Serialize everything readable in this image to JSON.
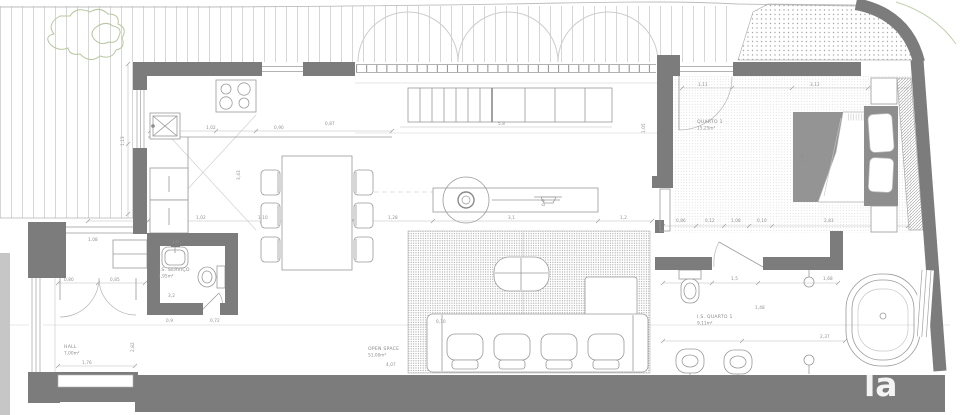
{
  "document": {
    "type": "floor-plan",
    "style": "architectural drawing, top view"
  },
  "watermark": "la",
  "colors": {
    "wall": "#7c7c7c",
    "bed_fill": "#949494",
    "headboard_fill": "#8e8e8e",
    "furniture_line": "#9a9a9a",
    "deck_line": "#d6d6d6",
    "dim_text": "#8e8e8e",
    "plant_green": "#b8c7a0",
    "background": "#ffffff"
  },
  "rooms": [
    {
      "id": "quarto1",
      "name": "QUARTO 1",
      "area": "15,25m²"
    },
    {
      "id": "is_quarto1",
      "name": "I.S. QUARTO 1",
      "area": "9,11m²"
    },
    {
      "id": "open_space",
      "name": "OPEN SPACE",
      "area": "51,00m²"
    },
    {
      "id": "hall",
      "name": "HALL",
      "area": "7,00m²"
    },
    {
      "id": "is_servico",
      "name": "I.S. SERVIÇO",
      "area": "1,95m²"
    }
  ],
  "fixtures": [
    "cooktop-symbol",
    "kitchen-sink-symbol",
    "fridge-symbol",
    "oven-symbol",
    "dining-table-symbol",
    "chair-symbol",
    "island-counter-symbol",
    "island-round-sink-symbol",
    "stairs-symbol",
    "rug-symbol",
    "sofa-symbol",
    "coffee-table-symbol",
    "chaise-symbol",
    "bed-symbol",
    "pillow-symbol",
    "nightstand-symbol",
    "wardrobe-symbol",
    "bathtub-symbol",
    "toilet-symbol",
    "bidet-symbol",
    "washbasin-symbol",
    "drain-symbol",
    "door-swing-symbol",
    "window-symbol",
    "deck-symbol",
    "patio-symbol",
    "plant-symbol"
  ],
  "dimensions": [
    {
      "t": "1,02",
      "x": 196,
      "y": 219
    },
    {
      "t": "1,10",
      "x": 258,
      "y": 219
    },
    {
      "t": "1,28",
      "x": 388,
      "y": 219
    },
    {
      "t": "3,1",
      "x": 508,
      "y": 219
    },
    {
      "t": "1,2",
      "x": 620,
      "y": 219
    },
    {
      "t": "1,02",
      "x": 206,
      "y": 129
    },
    {
      "t": "0,90",
      "x": 274,
      "y": 129
    },
    {
      "t": "0,87",
      "x": 325,
      "y": 125
    },
    {
      "t": "5,8",
      "x": 498,
      "y": 125
    },
    {
      "t": "1,13",
      "x": 124,
      "y": 146,
      "r": -90
    },
    {
      "t": "3,43",
      "x": 240,
      "y": 180,
      "r": -90
    },
    {
      "t": "1,05",
      "x": 645,
      "y": 133,
      "r": -90
    },
    {
      "t": "0,9",
      "x": 545,
      "y": 206,
      "r": -90
    },
    {
      "t": "0,80",
      "x": 64,
      "y": 281
    },
    {
      "t": "0,85",
      "x": 110,
      "y": 281
    },
    {
      "t": "1,08",
      "x": 88,
      "y": 241
    },
    {
      "t": "1,0",
      "x": 172,
      "y": 243
    },
    {
      "t": "3,2",
      "x": 168,
      "y": 297
    },
    {
      "t": "0,9",
      "x": 166,
      "y": 322
    },
    {
      "t": "0,72",
      "x": 210,
      "y": 322
    },
    {
      "t": "1,76",
      "x": 82,
      "y": 364
    },
    {
      "t": "2,82",
      "x": 134,
      "y": 352,
      "r": -90
    },
    {
      "t": "0,10",
      "x": 436,
      "y": 323
    },
    {
      "t": "4,07",
      "x": 386,
      "y": 366
    },
    {
      "t": "0,86",
      "x": 676,
      "y": 222
    },
    {
      "t": "0,12",
      "x": 705,
      "y": 222
    },
    {
      "t": "1,08",
      "x": 731,
      "y": 222
    },
    {
      "t": "0,10",
      "x": 757,
      "y": 222
    },
    {
      "t": "2,83",
      "x": 824,
      "y": 222
    },
    {
      "t": "1,11",
      "x": 698,
      "y": 86
    },
    {
      "t": "3,12",
      "x": 810,
      "y": 86
    },
    {
      "t": "1,60",
      "x": 804,
      "y": 163,
      "r": -90
    },
    {
      "t": "1,5",
      "x": 731,
      "y": 280
    },
    {
      "t": "1,68",
      "x": 823,
      "y": 280
    },
    {
      "t": "1,48",
      "x": 755,
      "y": 309
    },
    {
      "t": "2,37",
      "x": 820,
      "y": 338
    }
  ]
}
